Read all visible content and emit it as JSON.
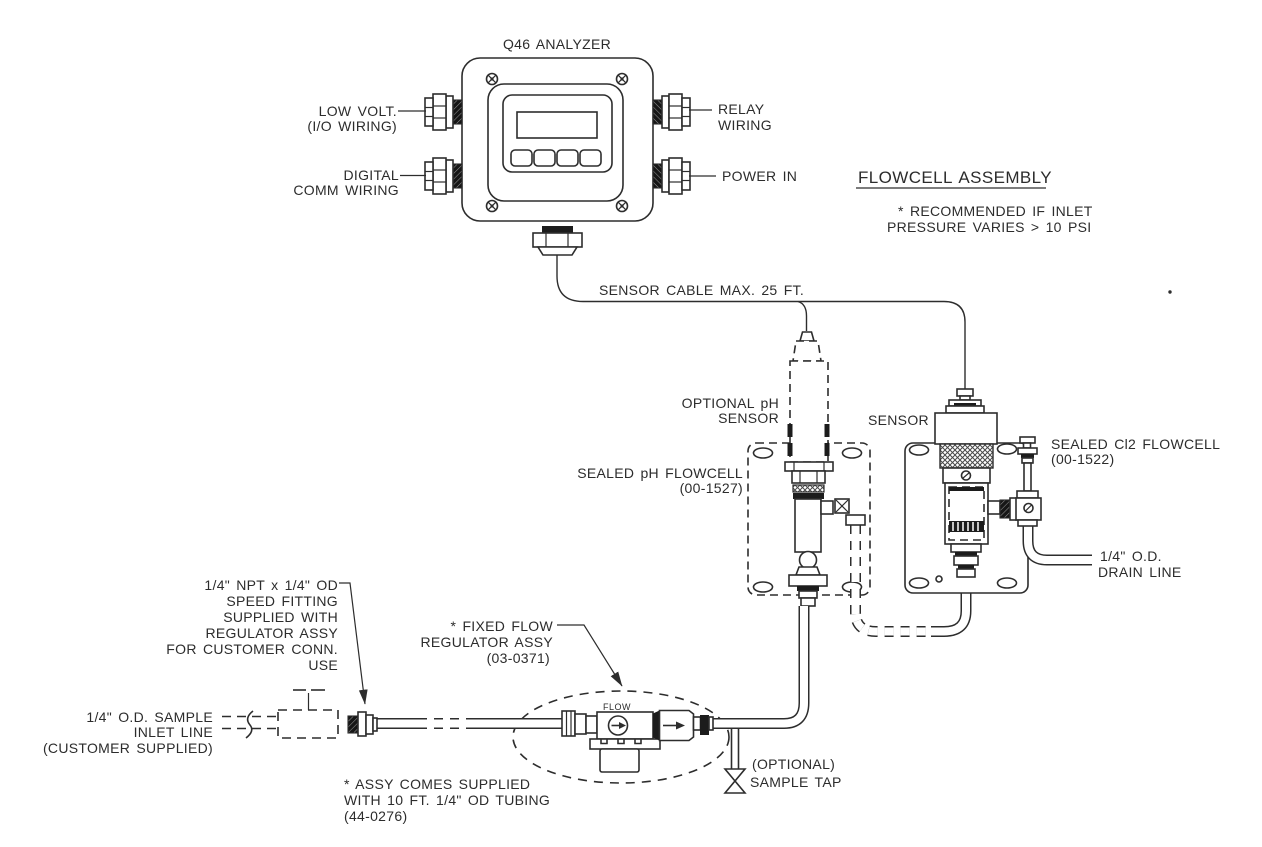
{
  "diagram": {
    "analyzer": {
      "title": "Q46 ANALYZER",
      "low_volt": [
        "LOW VOLT.",
        "(I/O WIRING)"
      ],
      "digital_comm": [
        "DIGITAL",
        "COMM WIRING"
      ],
      "relay": [
        "RELAY",
        "WIRING"
      ],
      "power_in": "POWER IN"
    },
    "flowcell_assembly": {
      "heading": "FLOWCELL ASSEMBLY",
      "note": [
        "* RECOMMENDED IF INLET",
        "PRESSURE VARIES > 10 PSI"
      ]
    },
    "cable": {
      "label": "SENSOR CABLE MAX. 25 FT."
    },
    "ph": {
      "sensor": [
        "OPTIONAL pH",
        "SENSOR"
      ],
      "flowcell": [
        "SEALED pH FLOWCELL",
        "(00-1527)"
      ]
    },
    "cl2": {
      "sensor_label": "SENSOR",
      "flowcell": [
        "SEALED Cl2 FLOWCELL",
        "(00-1522)"
      ],
      "drain": [
        "1/4\" O.D.",
        "DRAIN LINE"
      ]
    },
    "regulator": {
      "label": [
        "* FIXED FLOW",
        "REGULATOR ASSY",
        "(03-0371)"
      ],
      "flow_label": "FLOW",
      "tubing_note": [
        "* ASSY COMES SUPPLIED",
        "WITH 10 FT. 1/4\" OD TUBING",
        "(44-0276)"
      ]
    },
    "fitting": {
      "label": [
        "1/4\" NPT x 1/4\" OD",
        "SPEED FITTING",
        "SUPPLIED WITH",
        "REGULATOR ASSY",
        "FOR CUSTOMER CONN.",
        "USE"
      ]
    },
    "inlet": {
      "label": [
        "1/4\" O.D. SAMPLE",
        "INLET LINE",
        "(CUSTOMER SUPPLIED)"
      ]
    },
    "sample_tap": [
      "(OPTIONAL)",
      "SAMPLE TAP"
    ],
    "colors": {
      "line": "#2d2d2d",
      "background": "#ffffff"
    }
  }
}
